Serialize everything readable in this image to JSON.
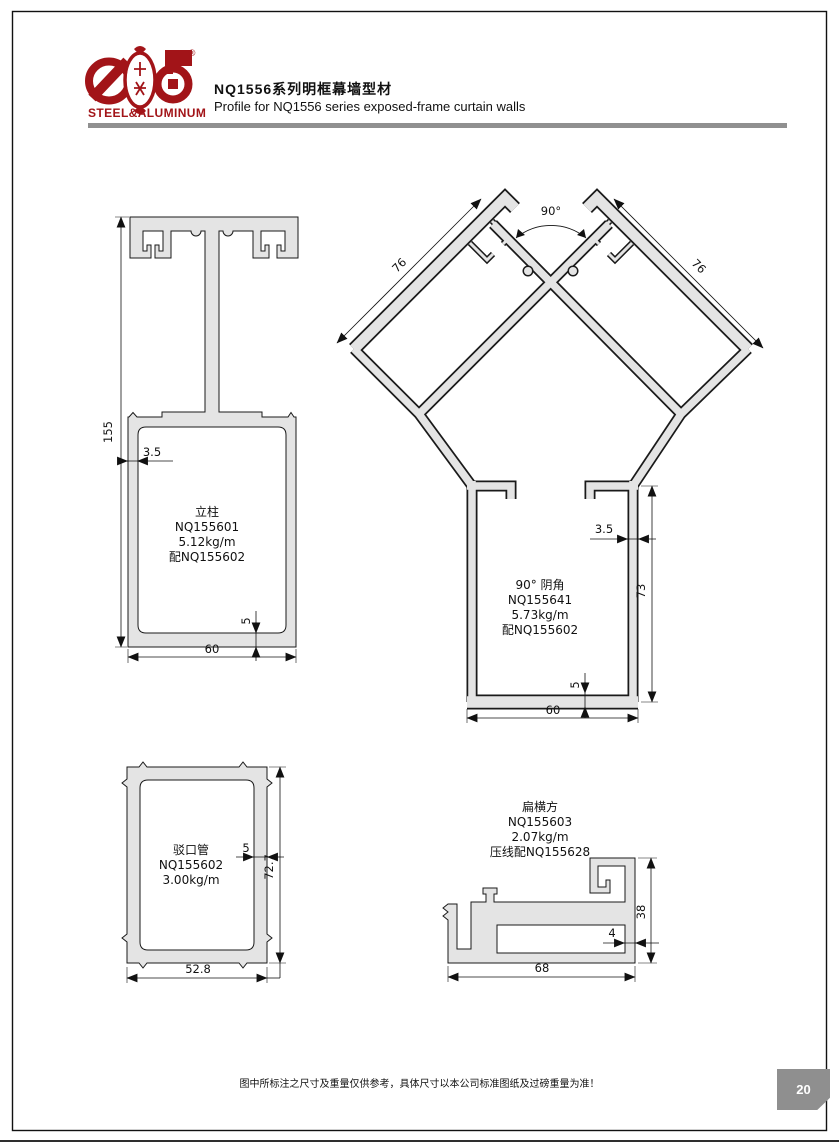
{
  "header": {
    "logo_text": "STEEL&ALUMINUM",
    "reg_mark": "®",
    "title_cn": "NQ1556系列明框幕墙型材",
    "title_en": "Profile for NQ1556 series exposed-frame curtain walls"
  },
  "profiles": {
    "mullion": {
      "name": "立柱",
      "code": "NQ155601",
      "weight": "5.12kg/m",
      "pair": "配NQ155602",
      "dims": {
        "height": "155",
        "wall": "3.5",
        "bottom_wall": "5",
        "width": "60"
      }
    },
    "corner": {
      "name": "90° 阴角",
      "code": "NQ155641",
      "weight": "5.73kg/m",
      "pair": "配NQ155602",
      "dims": {
        "angle": "90°",
        "arm_left": "76",
        "arm_right": "76",
        "wall": "3.5",
        "side": "73",
        "bottom_wall": "5",
        "width": "60"
      }
    },
    "tube": {
      "name": "驳口管",
      "code": "NQ155602",
      "weight": "3.00kg/m",
      "dims": {
        "wall": "5",
        "height": "72.7",
        "width": "52.8"
      }
    },
    "transom": {
      "name": "扁横方",
      "code": "NQ155603",
      "weight": "2.07kg/m",
      "pair": "压线配NQ155628",
      "dims": {
        "height": "38",
        "wall": "4",
        "width": "68"
      }
    }
  },
  "footer": {
    "note": "图中所标注之尺寸及重量仅供参考，具体尺寸以本公司标准图纸及过磅重量为准！",
    "page_number": "20"
  },
  "colors": {
    "brand_red": "#A21418",
    "profile_fill": "#E4E4E4",
    "rule_gray": "#909090",
    "page_tab_gray": "#8F8F8F"
  }
}
